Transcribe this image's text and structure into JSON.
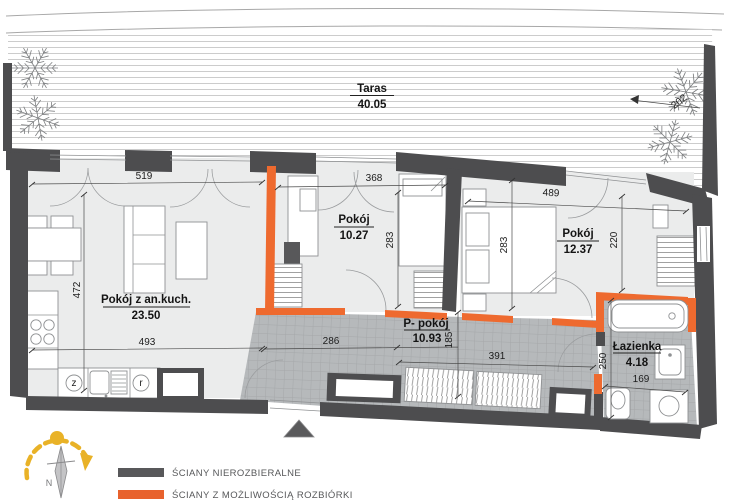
{
  "terrace": {
    "label": "Taras",
    "area": "40.05",
    "dim_edge": "202"
  },
  "rooms": {
    "living": {
      "label": "Pokój z an.kuch.",
      "area": "23.50"
    },
    "room1": {
      "label": "Pokój",
      "area": "10.27"
    },
    "room2": {
      "label": "Pokój",
      "area": "12.37"
    },
    "hall": {
      "label": "P- pokój",
      "area": "10.93"
    },
    "bath": {
      "label": "Łazienka",
      "area": "4.18"
    }
  },
  "dimensions": {
    "living_top": "519",
    "living_left": "472",
    "living_bottom": "493",
    "room1_top": "368",
    "room1_right": "283",
    "room2_top": "489",
    "room2_left": "283",
    "room2_right": "220",
    "hall_width": "286",
    "hall_height": "185",
    "hall_bottom": "391",
    "bath_height": "250",
    "bath_width": "169"
  },
  "kitchen": {
    "appliance_z": "z",
    "appliance_r": "r"
  },
  "compass": {
    "north": "N"
  },
  "legend": {
    "items": [
      {
        "label": "ŚCIANY NIEROZBIERALNE",
        "color": "#58585a"
      },
      {
        "label": "ŚCIANY Z MOŻLIWOŚCIĄ ROZBIÓRKI",
        "color": "#e8622d"
      }
    ]
  },
  "colors": {
    "wall": "#4d4d4f",
    "demolition_wall": "#ee6a2f",
    "room_floor": "#ebecec",
    "tile_floor": "#b6b9bb",
    "sun_path": "#e9b227"
  }
}
